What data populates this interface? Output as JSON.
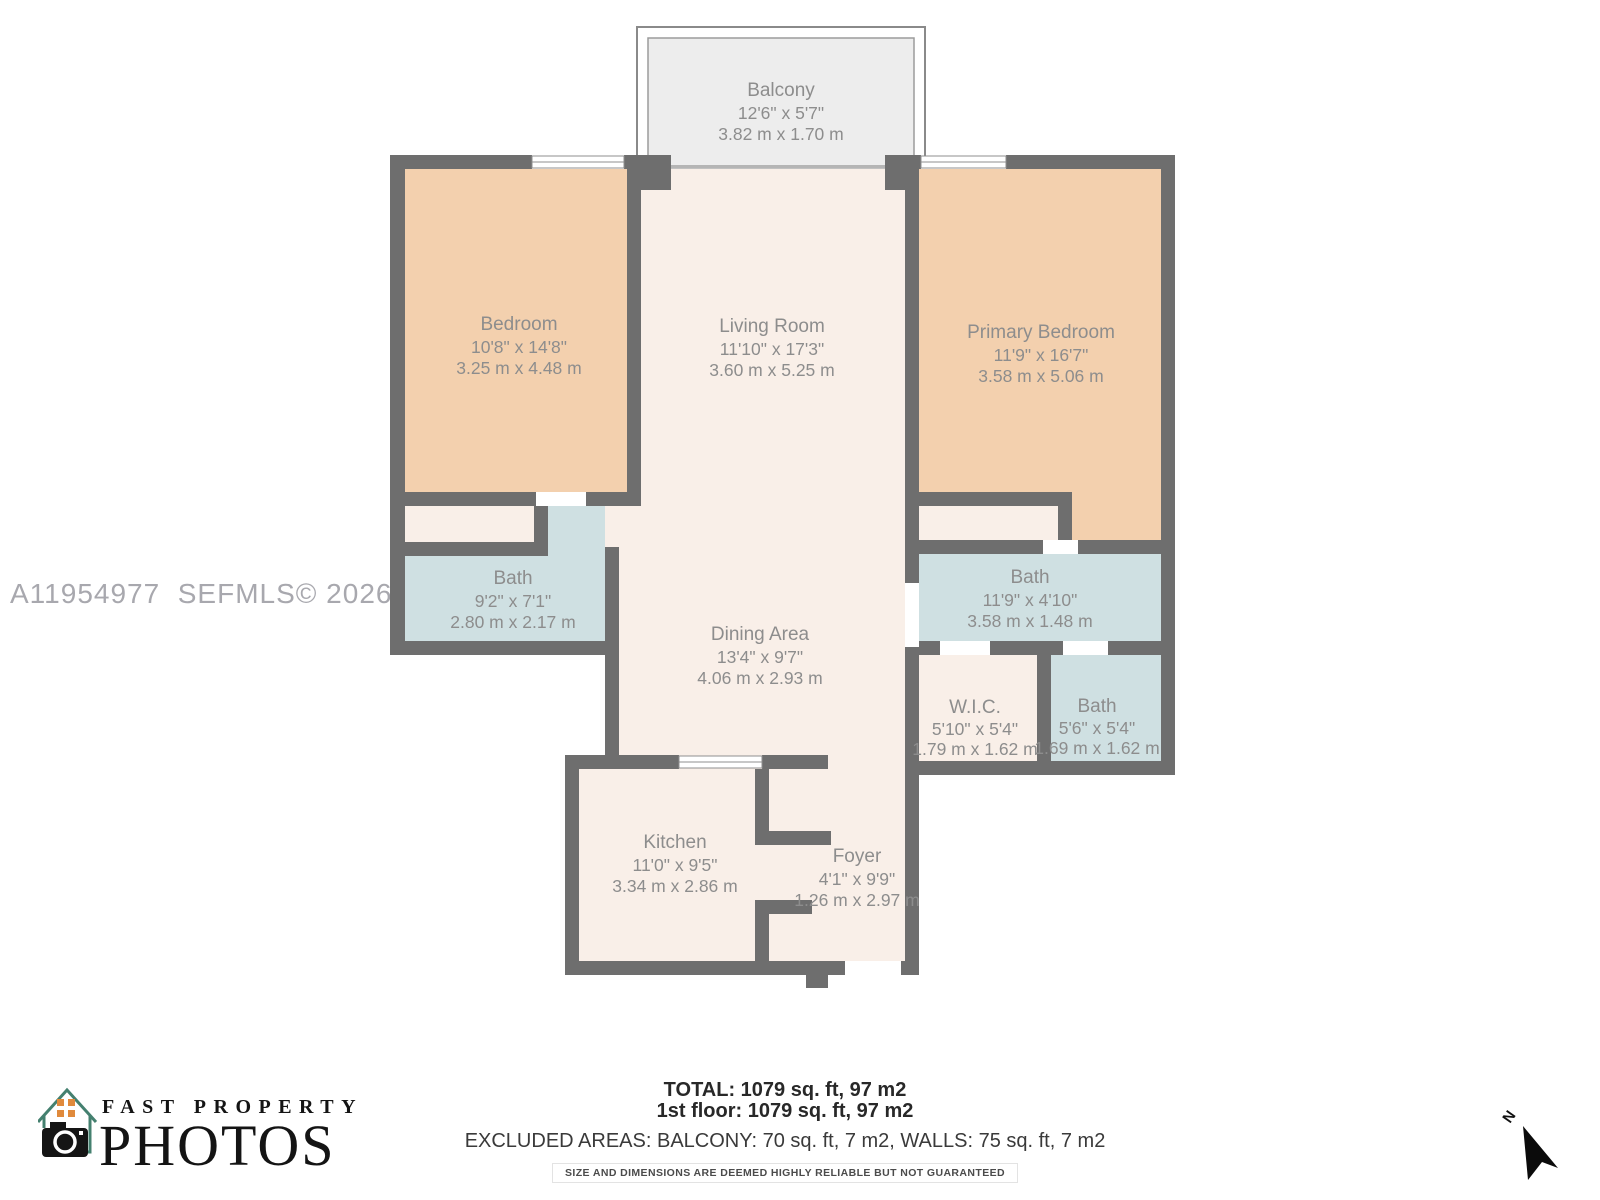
{
  "watermark": {
    "text": "A11954977  SEFMLS© 2026"
  },
  "rooms": {
    "balcony": {
      "name": "Balcony",
      "imperial": "12'6\" x 5'7\"",
      "metric": "3.82 m x 1.70 m"
    },
    "bedroom": {
      "name": "Bedroom",
      "imperial": "10'8\" x 14'8\"",
      "metric": "3.25 m x 4.48 m"
    },
    "living_room": {
      "name": "Living Room",
      "imperial": "11'10\" x 17'3\"",
      "metric": "3.60 m x 5.25 m"
    },
    "primary_bedroom": {
      "name": "Primary Bedroom",
      "imperial": "11'9\" x 16'7\"",
      "metric": "3.58 m x 5.06 m"
    },
    "bath_left": {
      "name": "Bath",
      "imperial": "9'2\" x 7'1\"",
      "metric": "2.80 m x 2.17 m"
    },
    "bath_right": {
      "name": "Bath",
      "imperial": "11'9\" x 4'10\"",
      "metric": "3.58 m x 1.48 m"
    },
    "dining_area": {
      "name": "Dining Area",
      "imperial": "13'4\" x 9'7\"",
      "metric": "4.06 m x 2.93 m"
    },
    "wic": {
      "name": "W.I.C.",
      "imperial": "5'10\" x 5'4\"",
      "metric": "1.79 m x 1.62 m"
    },
    "bath_small": {
      "name": "Bath",
      "imperial": "5'6\" x 5'4\"",
      "metric": "1.69 m x 1.62 m"
    },
    "kitchen": {
      "name": "Kitchen",
      "imperial": "11'0\" x 9'5\"",
      "metric": "3.34 m x 2.86 m"
    },
    "foyer": {
      "name": "Foyer",
      "imperial": "4'1\" x 9'9\"",
      "metric": "1.26 m x 2.97 m"
    }
  },
  "summary": {
    "total": "TOTAL: 1079 sq. ft, 97 m2",
    "floor": "1st floor: 1079 sq. ft, 97 m2",
    "excluded": "EXCLUDED AREAS: BALCONY: 70 sq. ft, 7 m2, WALLS: 75 sq. ft, 7 m2",
    "disclaimer": "SIZE AND DIMENSIONS ARE DEEMED HIGHLY RELIABLE BUT NOT GUARANTEED"
  },
  "logo": {
    "line1": "FAST PROPERTY",
    "line2": "PHOTOS"
  },
  "compass": {
    "label": "N"
  },
  "colors": {
    "wall": "#6e6e6e",
    "bedroom_fill": "#f3d0ae",
    "living_fill": "#f9efe8",
    "bath_fill": "#cfe0e2",
    "balcony_fill": "#ededed",
    "label_text": "#8d8d8d",
    "watermark_text": "#a8a8ae",
    "summary_text": "#282828",
    "logo_teal": "#44806f",
    "logo_orange": "#e08a3c"
  }
}
